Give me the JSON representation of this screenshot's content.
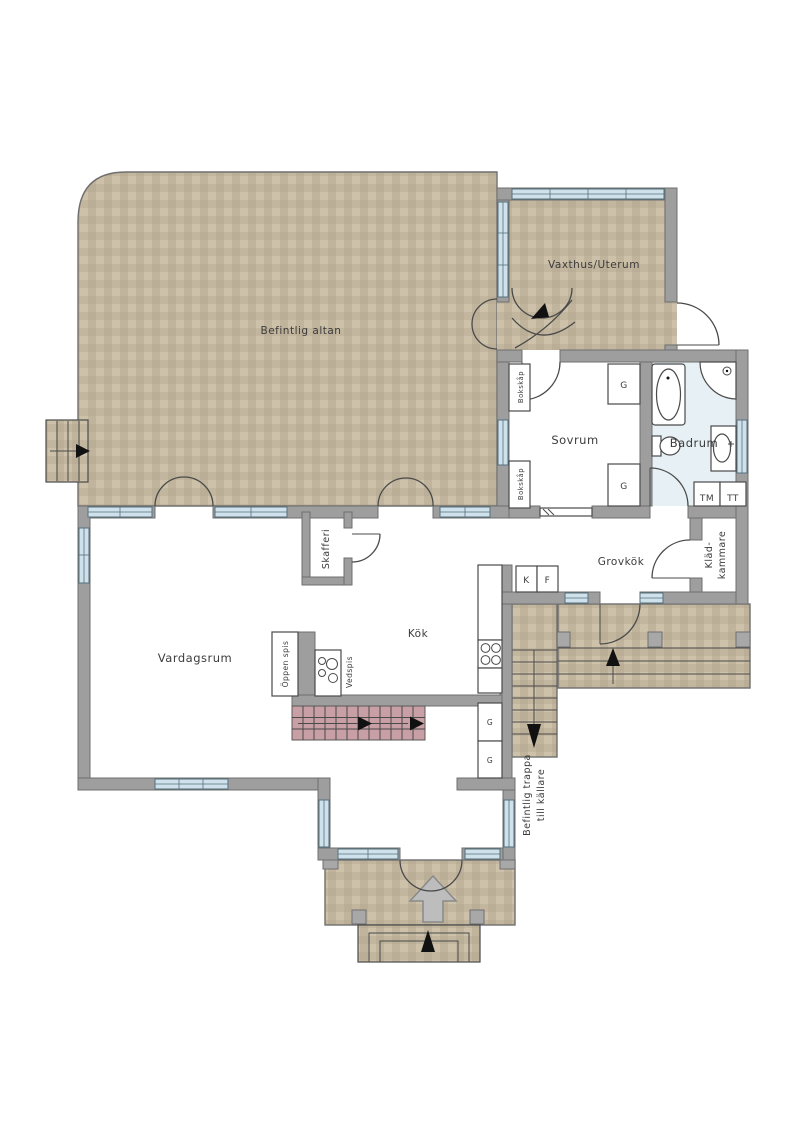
{
  "plan": {
    "rooms": {
      "altan": "Befintlig altan",
      "vaxthus": "Vaxthus/Uterum",
      "sovrum": "Sovrum",
      "badrum": "Badrum",
      "grovkok": "Grovkök",
      "kladkammare_line1": "Kläd-",
      "kladkammare_line2": "kammare",
      "kok": "Kök",
      "vardagsrum": "Vardagsrum",
      "skafferi": "Skafferi"
    },
    "fixtures": {
      "oppen_spis": "Öppen spis",
      "vedspis": "Vedspis",
      "bokskap": "Bokskåp",
      "garderob": "G",
      "kyl": "K",
      "frys": "F",
      "tvattmaskin": "TM",
      "torktumlare": "TT"
    },
    "annotations": {
      "trappa_line1": "Befintlig trappa",
      "trappa_line2": "till källare"
    },
    "colors": {
      "wall": "#9e9e9e",
      "wall_outline": "#6f6f6f",
      "deck": "#c6b9a1",
      "bathroom_floor": "#e7f0f4",
      "window": "#cfe2ec",
      "stairs_up_pink": "#c79fa4",
      "floor": "#ffffff",
      "ink": "#4a4a4a"
    }
  }
}
